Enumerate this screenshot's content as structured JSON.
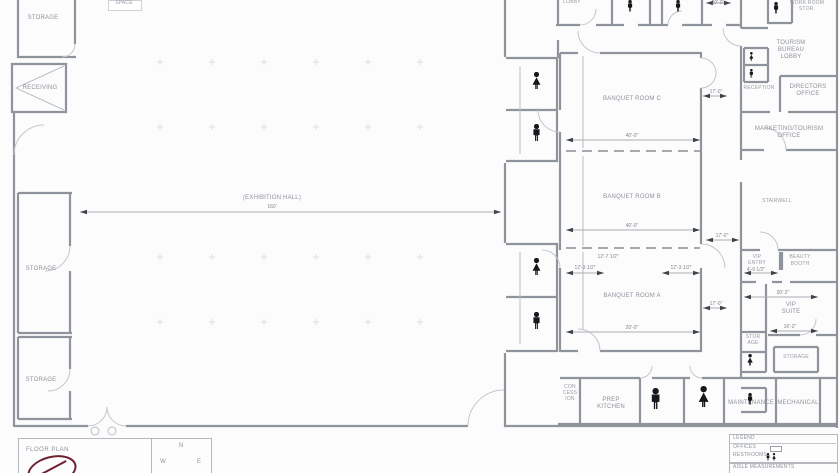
{
  "rooms": {
    "space_partial": "SPACE",
    "storage_top_left": "STORAGE",
    "receiving": "RECEIVING",
    "storage_mid_left": "STORAGE",
    "storage_bottom_left": "STORAGE",
    "lobby_top": "LOBBY",
    "exhibition_label": "(EXHIBITION HALL)",
    "banquet_c": "BANQUET ROOM C",
    "banquet_b": "BANQUET ROOM B",
    "banquet_a": "BANQUET ROOM A",
    "concession_line1": "CON",
    "concession_line2": "CESS",
    "concession_line3": "ION",
    "prep_kitchen_line1": "PREP",
    "prep_kitchen_line2": "KITCHEN",
    "maintenance": "MAINTENANCE",
    "mechanical": "MECHANICAL",
    "work_room_line1": "WORK ROOM",
    "work_room_line2": "STOR.",
    "tourism_line1": "TOURISM",
    "tourism_line2": "BUREAU",
    "tourism_line3": "LOBBY",
    "directors_line1": "DIRECTORS",
    "directors_line2": "OFFICE",
    "reception": "RECEPTION",
    "marketing_line1": "MARKETING/TOURISM",
    "marketing_line2": "OFFICE",
    "stairwell": "STAIRWELL",
    "vip_entry_line1": "VIP",
    "vip_entry_line2": "ENTRY",
    "beauty_line1": "BEAUTY",
    "beauty_line2": "BOOTH",
    "vip_suite_line1": "VIP",
    "vip_suite_line2": "SUITE",
    "storage_right_line1": "STOR",
    "storage_right_line2": "AGE",
    "storage_bottom_right": "STORAGE"
  },
  "dims": {
    "exhibition": "160'",
    "banquet_c": "40'-0\"",
    "banquet_b": "40'-0\"",
    "banquet_a": "20'-0\"",
    "partition_center": "12'-7 1/2\"",
    "partition_left": "12'-3 1/2\"",
    "partition_right": "12'-3 1/2\"",
    "corridor_top": "17'-0\"",
    "corridor_mid": "17'-0\"",
    "corridor_bottom": "17'-0\"",
    "top_right": "20'-0\"",
    "vip_entry": "4'-9 1/2\"",
    "suite_width": "20'-2\"",
    "suite_height": "16'-2\""
  },
  "legend": {
    "title": "LEGEND",
    "offices": "OFFICES",
    "restrooms": "RESTROOMS",
    "note": "AISLE MEASUREMENTS"
  },
  "titleblock": {
    "title": "FLOOR PLAN",
    "north": "N",
    "west": "W",
    "east": "E"
  }
}
